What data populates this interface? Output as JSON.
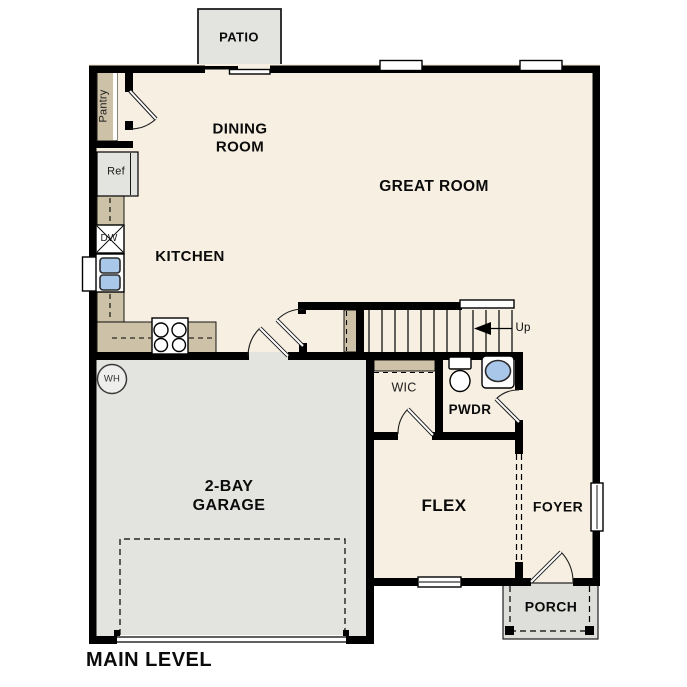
{
  "title": {
    "label": "MAIN LEVEL"
  },
  "colors": {
    "wall": "#000000",
    "floor": "#f6efe2",
    "hard": "#e3e3e0",
    "porch": "#dededb",
    "cabinet": "#cdc2a8",
    "fixture_blue": "#a9c8e9"
  },
  "rooms": {
    "patio": "PATIO",
    "dining": {
      "lines": [
        "DINING",
        "ROOM"
      ]
    },
    "great_room": "GREAT ROOM",
    "kitchen": "KITCHEN",
    "garage": {
      "lines": [
        "2-BAY",
        "GARAGE"
      ]
    },
    "wic": "WIC",
    "powder": "PWDR",
    "flex": "FLEX",
    "foyer": "FOYER",
    "porch": "PORCH"
  },
  "fixtures": {
    "pantry": "Pantry",
    "refrigerator": "Ref",
    "dishwasher": "DW",
    "water_heater": "WH"
  },
  "stairs": {
    "direction_label": "Up"
  }
}
